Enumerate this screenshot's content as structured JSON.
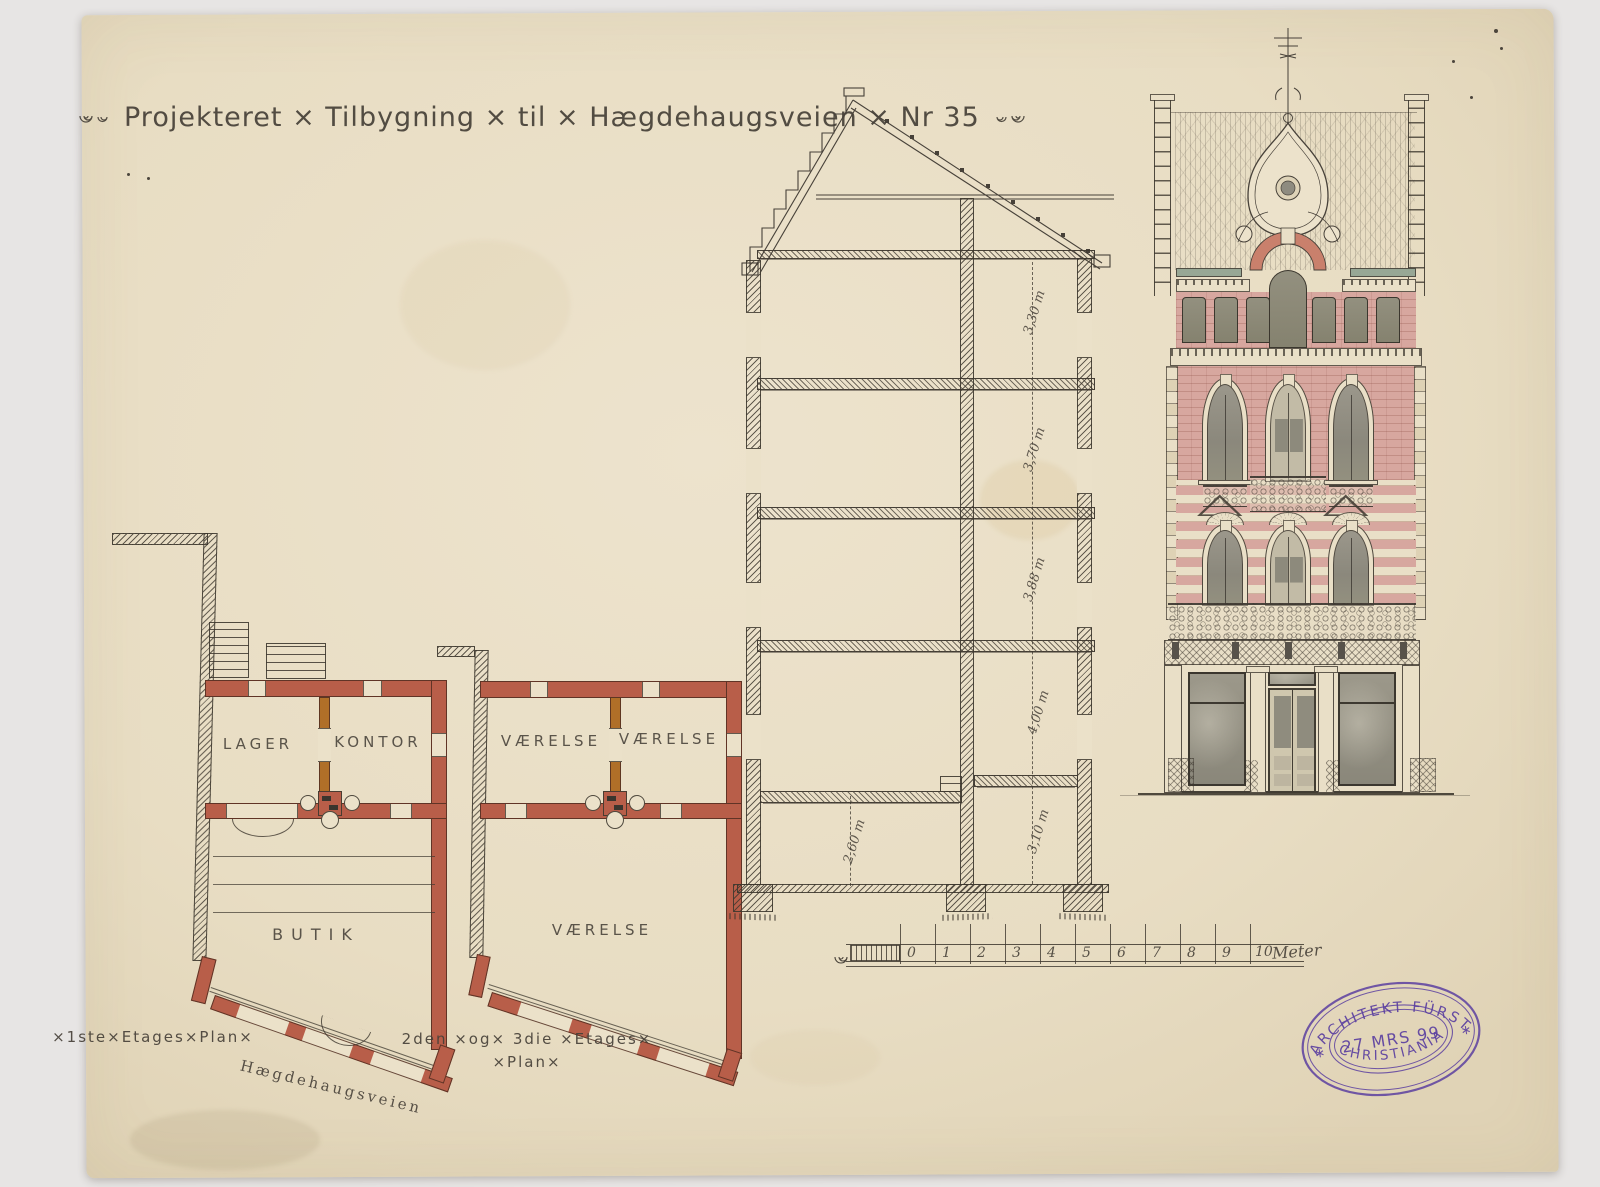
{
  "title": {
    "text": "Projekteret × Tilbygning × til × Hægdehaugsveien × Nr 35"
  },
  "plan1": {
    "room_a": "LAGER",
    "room_b": "KONTOR",
    "room_c": "BUTIK",
    "caption": "×1ste×Etages×Plan×"
  },
  "plan2": {
    "room_a": "VÆRELSE",
    "room_b": "VÆRELSE",
    "room_c": "VÆRELSE",
    "caption_line1": "2den ×og× 3die ×Etages×",
    "caption_line2": "×Plan×"
  },
  "street": {
    "label": "Hægdehaugsveien"
  },
  "section": {
    "dimensions": [
      "3,30 m",
      "3,70 m",
      "3,88 m",
      "4,00 m",
      "3,10 m",
      "2,60 m"
    ]
  },
  "scale_bar": {
    "ticks": [
      "0",
      "1",
      "2",
      "3",
      "4",
      "5",
      "6",
      "7",
      "8",
      "9"
    ],
    "end_value": "10",
    "unit": "Meter"
  },
  "stamp": {
    "line_top": "ARCHITEKT FÜRST",
    "line_center": "27 MRS 99",
    "line_bottom": "CHRISTIANIA",
    "star": "∗"
  },
  "colors": {
    "paper": "#ebe1c9",
    "ink": "#474139",
    "wall_red": "#b85e49",
    "door_orange": "#b06f28",
    "brick_pink": "#d7a79f",
    "stone_cream": "#e9dfc7",
    "band_green": "#97a795",
    "stamp_purple": "#5b3fa0",
    "glass_gray": "#94917f",
    "background": "#e7e5e4"
  }
}
